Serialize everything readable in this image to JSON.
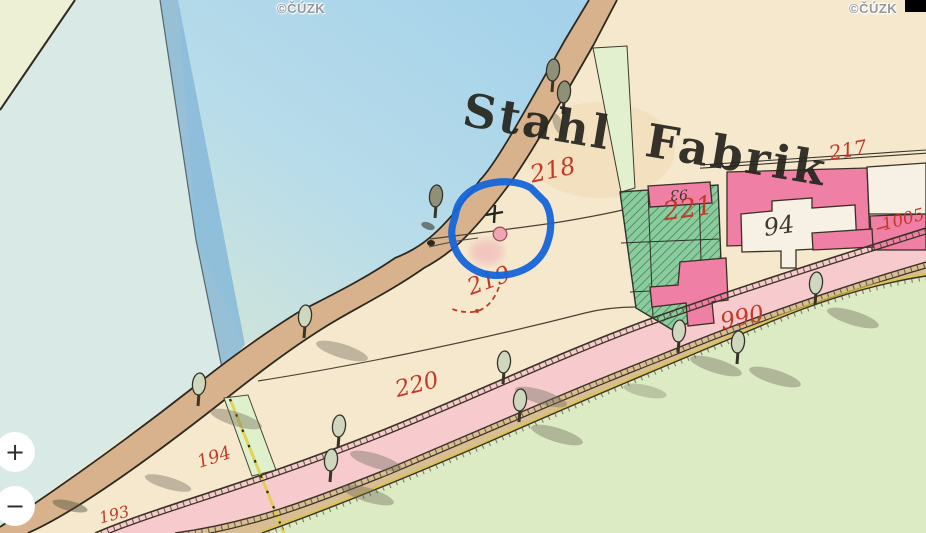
{
  "attribution": {
    "label": "©ČÚZK"
  },
  "controls": {
    "zoom_in_label": "+",
    "zoom_out_label": "−"
  },
  "map": {
    "title": "Stahl Fabrik",
    "labels": {
      "p217": "217",
      "p218": "218",
      "p219": "219",
      "p220": "220",
      "p221": "221",
      "p990": "990",
      "p1005": "1005",
      "p194": "194",
      "p193": "193",
      "b93": "93",
      "b94": "94"
    },
    "annotation_color": "#1565d8",
    "colors": {
      "water": "#a5d2ea",
      "water_pale": "#d9e9e6",
      "water_channel": "#86b8d8",
      "land": "#f5e8cd",
      "meadow": "#dcebc3",
      "road_pink": "#f7cbce",
      "road_tan": "#d9bd93",
      "shore_road": "#d8b28c",
      "garden": "#8bcc9e",
      "building_pink": "#f07fa6",
      "building_white": "#f6f1e4",
      "label_red": "#c43a28",
      "boundary_yellow": "#e0ce3e"
    }
  }
}
